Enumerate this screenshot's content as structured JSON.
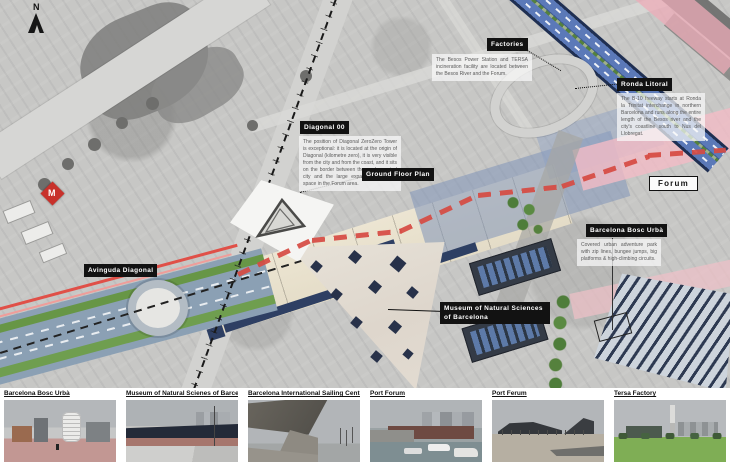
{
  "map": {
    "north_label": "N",
    "metro_label": "M",
    "annotations": {
      "factories": {
        "title": "Factories",
        "body": "The Besos Power Station and TERSA incineration facility are located between the Besos River and the Forum."
      },
      "ronda_litoral": {
        "title": "Ronda Litoral",
        "body": "The B-10 freeway starts at Ronda la Trinitat interchange in northern Barcelona and runs along the entire length of the Besos river and the city's coastline south to Nus del Llobregat."
      },
      "diagonal_00": {
        "title": "Diagonal 00",
        "body": "The position of Diagonal ZeroZero Tower is exceptional: it is located at the origin of Diagonal (kilometre zero), it is very visible from the city and from the coast, and it sits on the border between the agglomerated city and the large expanses of public space in the Forum area."
      },
      "ground_floor_plan": {
        "title": "Ground Floor Plan"
      },
      "forum": {
        "title": "Forum"
      },
      "bosc_urba": {
        "title": "Barcelona Bosc Urbà",
        "body": "Covered urban adventure park with zip lines, bungee jumps, big platforms & high-climbing circuits."
      },
      "museum": {
        "title": "Museum of Natural Sciences of Barcelona"
      },
      "avinguda_diagonal": {
        "title": "Avinguda Diagonal"
      }
    },
    "colors": {
      "red_dashed": "#d64a42",
      "tram_red": "#e05048",
      "highway_blue": "#4f6fae",
      "plaza_beige": "#e9e2cf",
      "pink_overlay": "#f0bcc6",
      "label_bg": "#121212",
      "metro_red": "#c8312b"
    }
  },
  "photos": [
    {
      "caption": "Barcelona Bosc Urbà"
    },
    {
      "caption": "Museum of Natural Scienes of Barcelona"
    },
    {
      "caption": "Barcelona International Sailing Center"
    },
    {
      "caption": "Port Forum"
    },
    {
      "caption": "Port Ferum"
    },
    {
      "caption": "Tersa Factory"
    }
  ]
}
